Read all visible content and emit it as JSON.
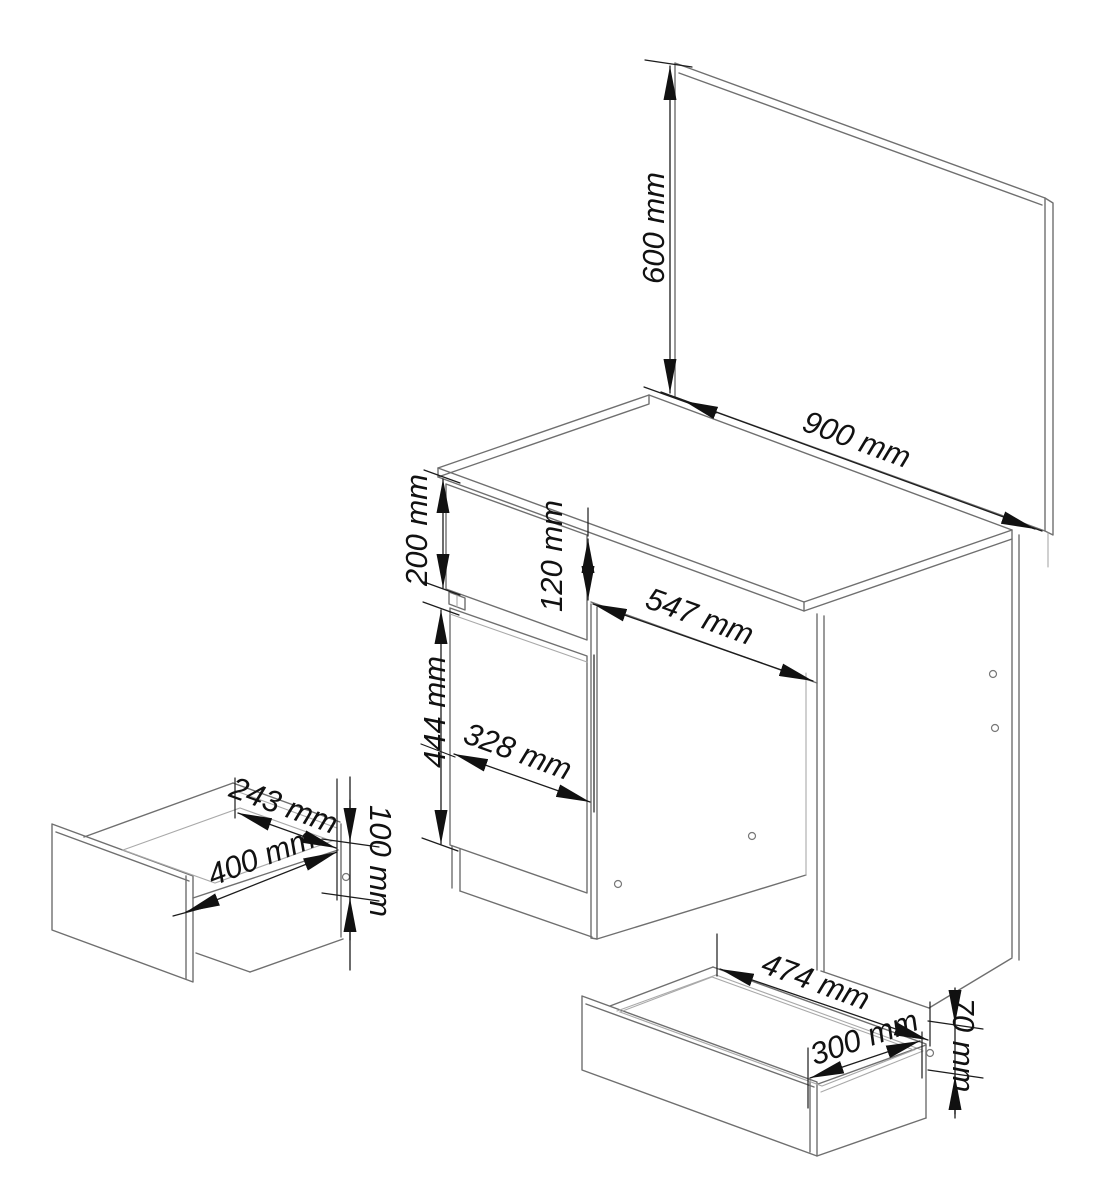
{
  "page": {
    "title": "Dressing table with mirror — assembly dimension diagram",
    "background": "#ffffff",
    "units": "mm"
  },
  "colors": {
    "outline": "#6f6f6f",
    "outline_light": "#a9a9a9",
    "dimension_line": "#1c1c1c",
    "label_text": "#111111"
  },
  "components": {
    "mirror": {
      "name": "mirror panel"
    },
    "desk_top": {
      "name": "desk top"
    },
    "top_drawer_front": {
      "name": "top drawer front"
    },
    "cabinet_door": {
      "name": "cabinet door"
    },
    "right_side_panel": {
      "name": "right side panel"
    },
    "small_drawer": {
      "name": "small drawer (exploded view)"
    },
    "large_drawer": {
      "name": "large drawer (exploded view)"
    }
  },
  "dimensions": {
    "mirror_height": {
      "label": "600 mm",
      "value": 600,
      "unit": "mm",
      "measures": "mirror panel height"
    },
    "mirror_width": {
      "label": "900 mm",
      "value": 900,
      "unit": "mm",
      "measures": "mirror / desk width"
    },
    "drawer_front_height": {
      "label": "200 mm",
      "value": 200,
      "unit": "mm",
      "measures": "top drawer front height"
    },
    "apron_height": {
      "label": "120 mm",
      "value": 120,
      "unit": "mm",
      "measures": "front apron height"
    },
    "knee_space_width": {
      "label": "547 mm",
      "value": 547,
      "unit": "mm",
      "measures": "knee space width"
    },
    "door_height": {
      "label": "444 mm",
      "value": 444,
      "unit": "mm",
      "measures": "cabinet door height"
    },
    "door_width": {
      "label": "328 mm",
      "value": 328,
      "unit": "mm",
      "measures": "cabinet door width"
    },
    "small_drawer_depth": {
      "label": "243 mm",
      "value": 243,
      "unit": "mm",
      "measures": "small drawer depth"
    },
    "small_drawer_width": {
      "label": "400 mm",
      "value": 400,
      "unit": "mm",
      "measures": "small drawer width"
    },
    "small_drawer_height": {
      "label": "100 mm",
      "value": 100,
      "unit": "mm",
      "measures": "small drawer height"
    },
    "large_drawer_width": {
      "label": "474 mm",
      "value": 474,
      "unit": "mm",
      "measures": "large drawer width"
    },
    "large_drawer_depth": {
      "label": "300 mm",
      "value": 300,
      "unit": "mm",
      "measures": "large drawer depth"
    },
    "large_drawer_height": {
      "label": "70 mm",
      "value": 70,
      "unit": "mm",
      "measures": "large drawer height"
    }
  }
}
